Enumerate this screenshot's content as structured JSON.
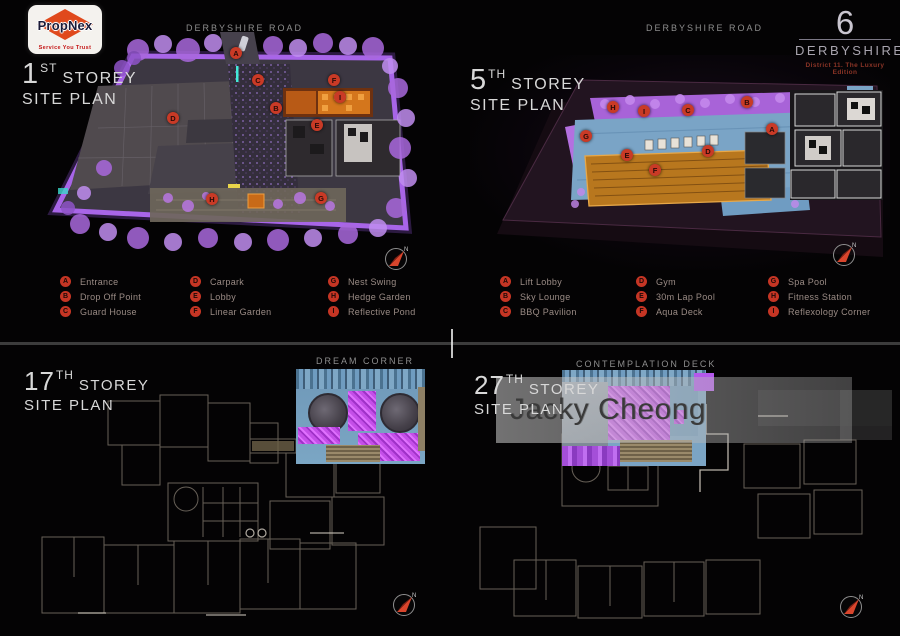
{
  "logo": {
    "brand": "PropNex",
    "tagline": "Service You Trust"
  },
  "brand_header": {
    "number": "6",
    "name": "DERBYSHIRE",
    "subtitle": "District 11. The Luxury Edition"
  },
  "labels": {
    "road": "DERBYSHIRE ROAD",
    "compass_north": "N"
  },
  "quadrants": {
    "first": {
      "num": "1",
      "sup": "ST",
      "storey": "STOREY",
      "plan": "SITE PLAN"
    },
    "fifth": {
      "num": "5",
      "sup": "TH",
      "storey": "STOREY",
      "plan": "SITE PLAN"
    },
    "seventeenth": {
      "num": "17",
      "sup": "TH",
      "storey": "STOREY",
      "plan": "SITE PLAN",
      "feature": "DREAM CORNER"
    },
    "twentyseventh": {
      "num": "27",
      "sup": "TH",
      "storey": "STOREY",
      "plan": "SITE PLAN",
      "feature": "CONTEMPLATION DECK"
    }
  },
  "legends": {
    "first": [
      {
        "key": "A",
        "label": "Entrance"
      },
      {
        "key": "B",
        "label": "Drop Off Point"
      },
      {
        "key": "C",
        "label": "Guard House"
      },
      {
        "key": "D",
        "label": "Carpark"
      },
      {
        "key": "E",
        "label": "Lobby"
      },
      {
        "key": "F",
        "label": "Linear Garden"
      },
      {
        "key": "G",
        "label": "Nest Swing"
      },
      {
        "key": "H",
        "label": "Hedge Garden"
      },
      {
        "key": "I",
        "label": "Reflective Pond"
      }
    ],
    "fifth": [
      {
        "key": "A",
        "label": "Lift Lobby"
      },
      {
        "key": "B",
        "label": "Sky Lounge"
      },
      {
        "key": "C",
        "label": "BBQ Pavilion"
      },
      {
        "key": "D",
        "label": "Gym"
      },
      {
        "key": "E",
        "label": "30m Lap Pool"
      },
      {
        "key": "F",
        "label": "Aqua Deck"
      },
      {
        "key": "G",
        "label": "Spa Pool"
      },
      {
        "key": "H",
        "label": "Fitness Station"
      },
      {
        "key": "I",
        "label": "Reflexology Corner"
      }
    ]
  },
  "markers": {
    "first": [
      "A",
      "B",
      "C",
      "D",
      "E",
      "F",
      "G",
      "H",
      "I"
    ],
    "fifth": [
      "A",
      "B",
      "C",
      "D",
      "E",
      "F",
      "G",
      "H",
      "I"
    ]
  },
  "watermark": {
    "text": "Jacky Cheong"
  },
  "colors": {
    "accent_red": "#c93a26",
    "tree_purple": "#b57ae6",
    "deck_blue": "#7aa4c6",
    "pool_gold": "#b8771e"
  }
}
